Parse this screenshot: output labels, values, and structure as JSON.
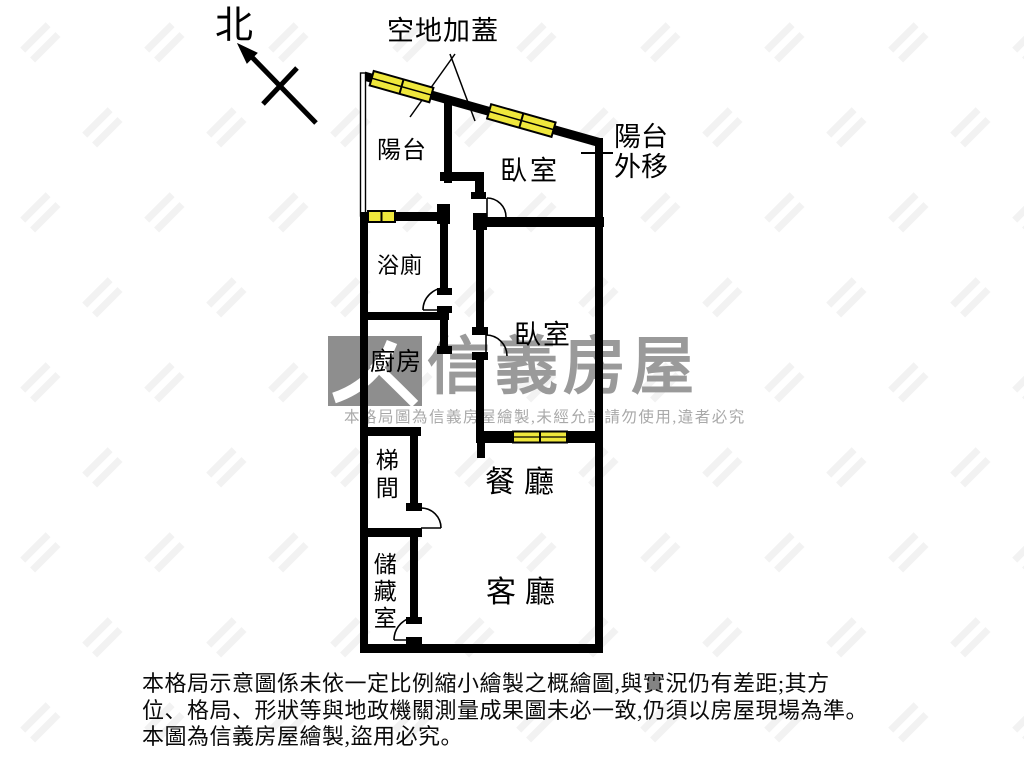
{
  "compass": {
    "label": "北"
  },
  "annotations": {
    "added_cover": "空地加蓋",
    "balcony_moved": "陽台外移"
  },
  "rooms": {
    "balcony": "陽台",
    "bedroom1": "臥室",
    "bedroom2": "臥室",
    "bathroom": "浴廁",
    "kitchen": "廚房",
    "stairwell": "梯間",
    "storage": "儲藏室",
    "dining": "餐廳",
    "living": "客廳"
  },
  "watermark": {
    "brand": "信義房屋",
    "notice": "本格局圖為信義房屋繪製,未經允許請勿使用,違者必究"
  },
  "disclaimer": {
    "line1": "本格局示意圖係未依一定比例縮小繪製之概繪圖,與實況仍有差距;其方",
    "line2": "位、格局、形狀等與地政機關測量成果圖未必一致,仍須以房屋現場為準。",
    "line3": "本圖為信義房屋繪製,盜用必究。"
  },
  "colors": {
    "wall": "#000000",
    "window_yellow": "#efe73c",
    "watermark_grey": "#9a9a9a",
    "logo_grey": "#8e8e8e",
    "notice_grey": "#a9a9a9",
    "background": "#ffffff"
  }
}
